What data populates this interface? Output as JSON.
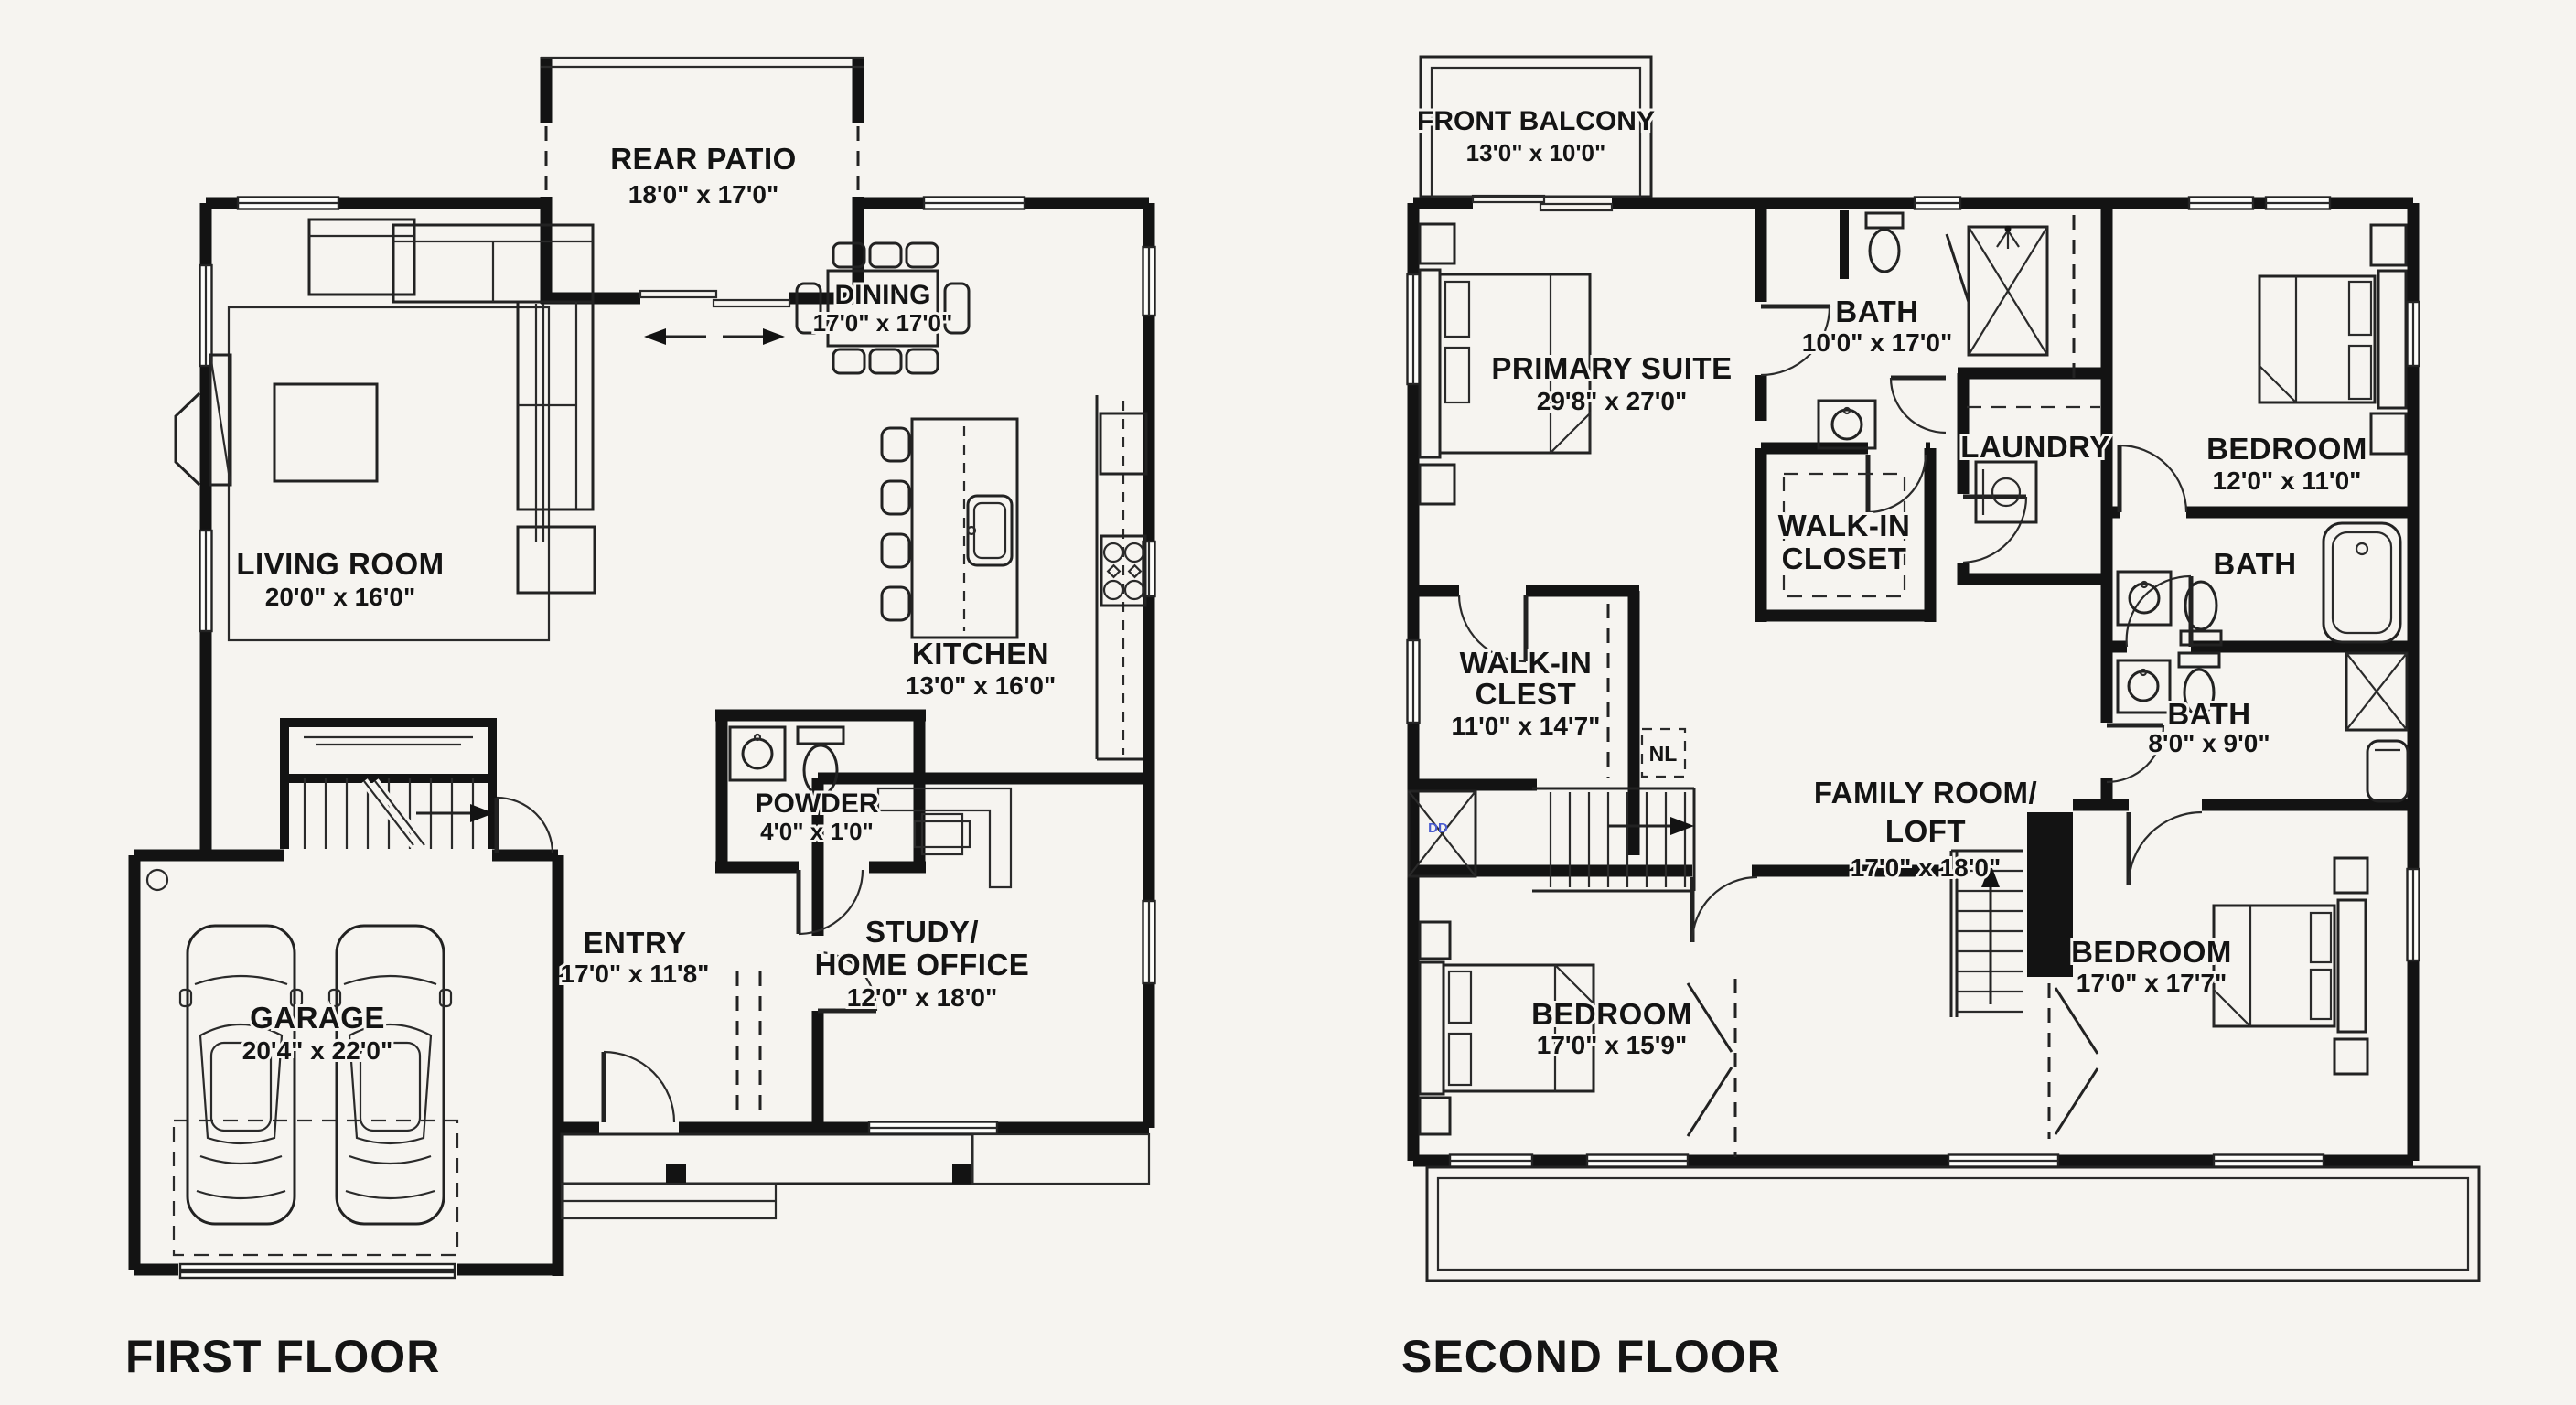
{
  "page": {
    "background": "#f6f4f0",
    "ink": "#131313"
  },
  "first_floor": {
    "title": "FIRST FLOOR",
    "rooms": {
      "rear_patio": {
        "name": "REAR PATIO",
        "dims": "18'0\" x 17'0\""
      },
      "dining": {
        "name": "DINING",
        "dims": "17'0\" x 17'0\""
      },
      "living_room": {
        "name": "LIVING ROOM",
        "dims": "20'0\" x 16'0\""
      },
      "kitchen": {
        "name": "KITCHEN",
        "dims": "13'0\" x 16'0\""
      },
      "powder": {
        "name": "POWDER",
        "dims": "4'0\" x 1'0\""
      },
      "entry": {
        "name": "ENTRY",
        "dims": "17'0\" x 11'8\""
      },
      "study": {
        "name": [
          "STUDY/",
          "HOME OFFICE"
        ],
        "dims": "12'0\" x 18'0\""
      },
      "garage": {
        "name": "GARAGE",
        "dims": "20'4\" x 22'0\""
      }
    }
  },
  "second_floor": {
    "title": "SECOND FLOOR",
    "rooms": {
      "front_balcony": {
        "name": "FRONT BALCONY",
        "dims": "13'0\" x 10'0\""
      },
      "primary_suite": {
        "name": "PRIMARY SUITE",
        "dims": "29'8\" x 27'0\""
      },
      "primary_bath": {
        "name": "BATH",
        "dims": "10'0\" x 17'0\""
      },
      "laundry": {
        "name": "LAUNDRY"
      },
      "bedroom_upper": {
        "name": "BEDROOM",
        "dims": "12'0\" x 11'0\""
      },
      "bath_upper": {
        "name": "BATH"
      },
      "walk_in_closet": {
        "name": [
          "WALK-IN",
          "CLOSET"
        ]
      },
      "walk_in_clest": {
        "name": [
          "WALK-IN",
          "CLEST"
        ],
        "dims": "11'0\" x 14'7\""
      },
      "family_room": {
        "name": [
          "FAMILY ROOM/",
          "LOFT"
        ],
        "dims": "17'0\" x 18'0\""
      },
      "bath_middle": {
        "name": "BATH",
        "dims": "8'0\" x 9'0\""
      },
      "bedroom_lower_left": {
        "name": "BEDROOM",
        "dims": "17'0\" x 15'9\""
      },
      "bedroom_lower_right": {
        "name": "BEDROOM",
        "dims": "17'0\" x 17'7\""
      },
      "stair_note": "NL",
      "chase_note": "DD"
    }
  }
}
